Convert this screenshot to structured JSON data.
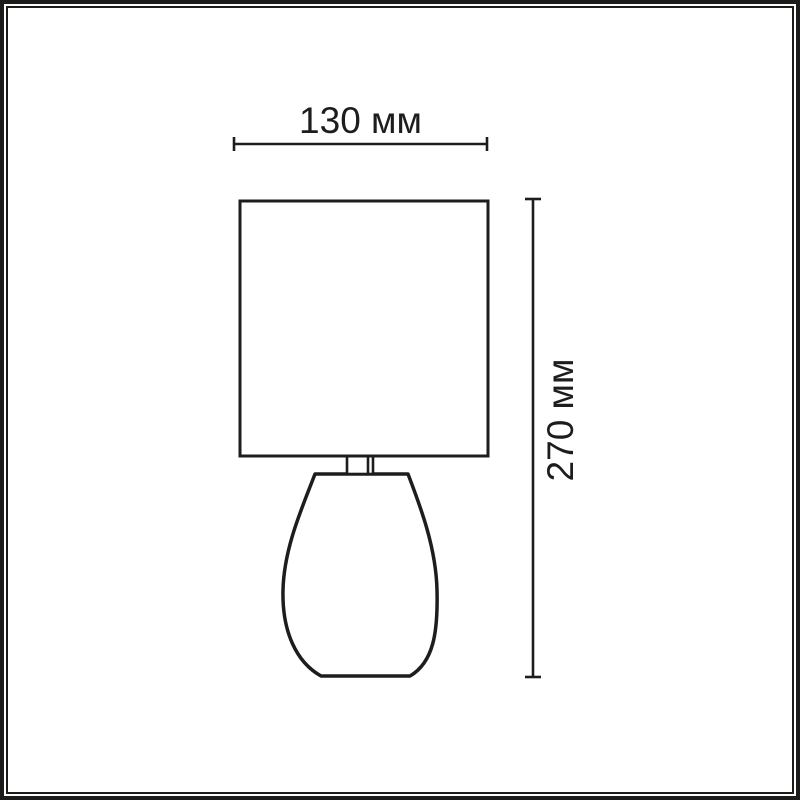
{
  "frame": {
    "border_color": "#1d1d1b",
    "background": "#ffffff"
  },
  "diagram": {
    "subject": "table-lamp-outline-drawing",
    "line_color": "#1d1d1b",
    "fill_color": "#ffffff",
    "dimensions": {
      "width": {
        "label": "130 мм"
      },
      "height": {
        "label": "270 мм"
      }
    }
  }
}
